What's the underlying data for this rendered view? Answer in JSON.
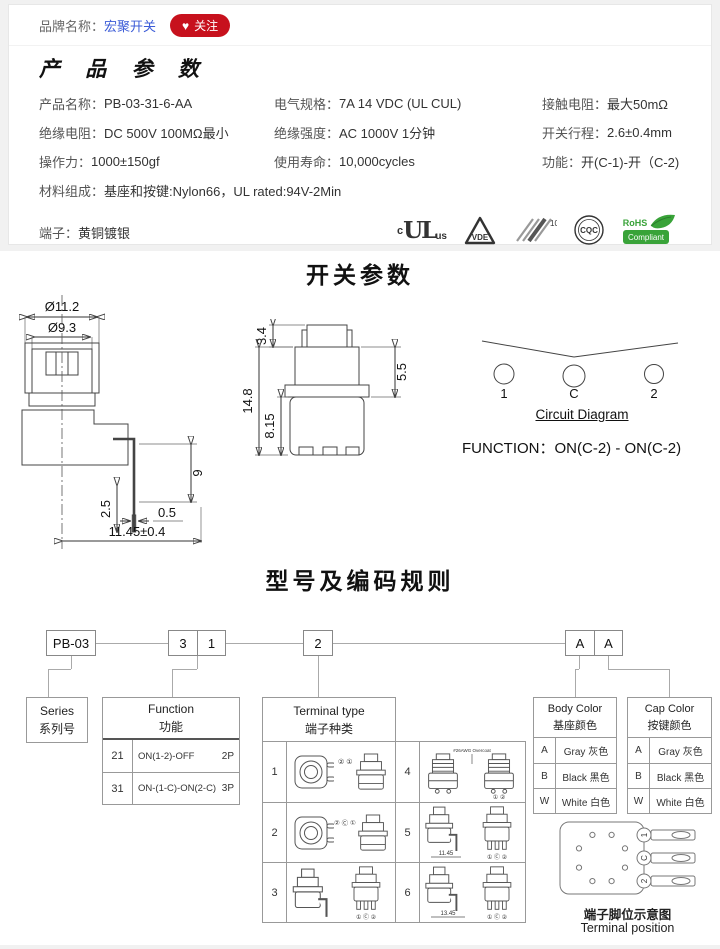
{
  "colors": {
    "accent_red": "#c7111d",
    "link_blue": "#3c5cd7",
    "rohs_green": "#39a339"
  },
  "brand_bar": {
    "label": "品牌名称：",
    "brand": "宏聚开关",
    "heart": "♥",
    "follow": "关注"
  },
  "product": {
    "title": "产 品 参 数",
    "specs": [
      {
        "label": "产品名称：",
        "value": "PB-03-31-6-AA"
      },
      {
        "label": "电气规格：",
        "value": "7A  14 VDC (UL CUL)"
      },
      {
        "label": "接触电阻：",
        "value": "最大50mΩ"
      },
      {
        "label": "绝缘电阻：",
        "value": "DC 500V 100MΩ最小"
      },
      {
        "label": "绝缘强度：",
        "value": "AC 1000V 1分钟"
      },
      {
        "label": "开关行程：",
        "value": "2.6±0.4mm"
      },
      {
        "label": "操作力：",
        "value": "1000±150gf"
      },
      {
        "label": "使用寿命：",
        "value": "10,000cycles"
      },
      {
        "label": "功能：",
        "value": "开(C-1)-开（C-2)"
      },
      {
        "label": "材料组成：",
        "value": "基座和按键:Nylon66，UL rated:94V-2Min"
      },
      {
        "label": "端子：",
        "value": "黄铜镀银"
      }
    ],
    "certs": {
      "ul_c": "c",
      "ul": "UL",
      "ul_us": "us",
      "vde": "VDE",
      "k10": "10",
      "cqc": "CQC",
      "rohs": "RoHS",
      "compliant": "Compliant"
    }
  },
  "switch_params": {
    "title": "开关参数",
    "side_view": {
      "dia_outer": "Ø11.2",
      "dia_inner": "Ø9.3",
      "lead_len": "9",
      "lead_offset": "2.5",
      "lead_width": "0.5",
      "overall": "11.45±0.4"
    },
    "front_view": {
      "plunger_h": "3.4",
      "overall_h": "14.8",
      "body_h": "8.15",
      "neck_h": "5.5"
    },
    "circuit": {
      "pin1": "1",
      "pinc": "C",
      "pin2": "2",
      "caption": "Circuit Diagram",
      "function_line": "FUNCTION：ON(C-2) - ON(C-2)"
    }
  },
  "coding": {
    "title": "型号及编码规则",
    "code": {
      "series": "PB-03",
      "func1": "3",
      "func2": "1",
      "terminal": "2",
      "body": "A",
      "cap": "A"
    },
    "series_box": {
      "en": "Series",
      "zh": "系列号"
    },
    "function_table": {
      "en": "Function",
      "zh": "功能",
      "rows": [
        {
          "code": "21",
          "desc": "ON(1-2)-OFF",
          "poles": "2P"
        },
        {
          "code": "31",
          "desc": "ON-(1-C)-ON(2-C)",
          "poles": "3P"
        }
      ]
    },
    "terminal_table": {
      "en": "Terminal type",
      "zh": "端子种类",
      "cells": [
        {
          "num": "1",
          "pins": "② ①"
        },
        {
          "num": "2",
          "pins": "② Ⓒ ①"
        },
        {
          "num": "3",
          "pins": "① Ⓒ ②"
        },
        {
          "num": "4",
          "note": "#26AWG Overcoat",
          "pins": "① ②"
        },
        {
          "num": "5",
          "dim": "11.45",
          "pins": "① Ⓒ ②"
        },
        {
          "num": "6",
          "dim": "13.45",
          "pins": "① Ⓒ ②"
        }
      ]
    },
    "body_color_table": {
      "en": "Body Color",
      "zh": "基座颜色",
      "rows": [
        {
          "code": "A",
          "name": "Gray 灰色"
        },
        {
          "code": "B",
          "name": "Black 黑色"
        },
        {
          "code": "W",
          "name": "White 白色"
        }
      ]
    },
    "cap_color_table": {
      "en": "Cap Color",
      "zh": "按键颜色",
      "rows": [
        {
          "code": "A",
          "name": "Gray 灰色"
        },
        {
          "code": "B",
          "name": "Black 黑色"
        },
        {
          "code": "W",
          "name": "White 白色"
        }
      ]
    },
    "terminal_position": {
      "zh": "端子脚位示意图",
      "en": "Terminal position",
      "pin1": "1",
      "pinc": "C",
      "pin2": "2"
    }
  }
}
